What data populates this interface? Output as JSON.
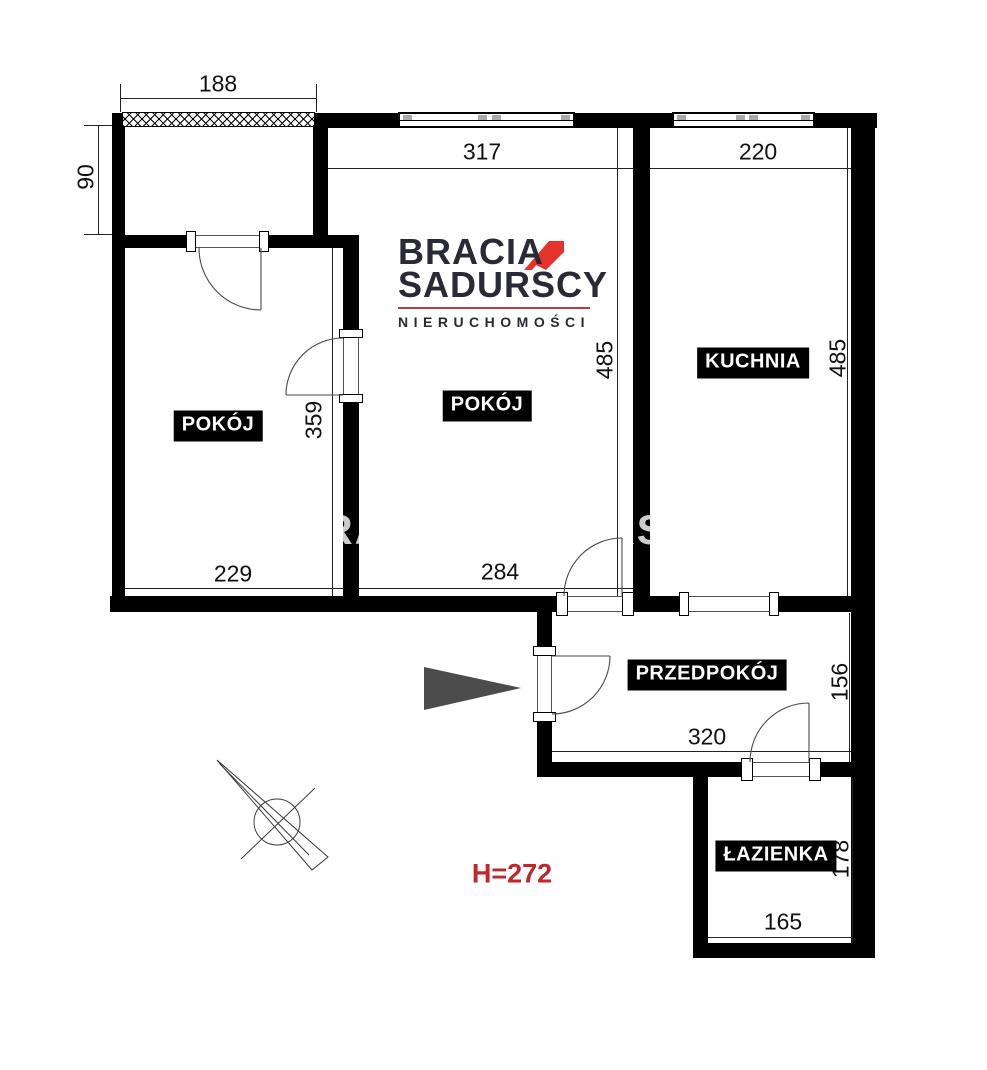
{
  "brand": {
    "line1": "BRACIA",
    "line2": "SADURSCY",
    "line3": "NIERUCHOMOŚCI",
    "logo_navy": "#2a2936",
    "logo_red": "#e5332a"
  },
  "watermark_text": "BRACIA SADURSCY",
  "rooms": [
    {
      "id": "pokoj-left",
      "label": "POKÓJ"
    },
    {
      "id": "pokoj-middle",
      "label": "POKÓJ"
    },
    {
      "id": "kuchnia",
      "label": "KUCHNIA"
    },
    {
      "id": "przedpokoj",
      "label": "PRZEDPOKÓJ"
    },
    {
      "id": "lazienka",
      "label": "ŁAZIENKA"
    }
  ],
  "dims": {
    "d188": "188",
    "d90": "90",
    "d317": "317",
    "d220": "220",
    "d485L": "485",
    "d485R": "485",
    "d359": "359",
    "d229": "229",
    "d284": "284",
    "d320": "320",
    "d156": "156",
    "d178": "178",
    "d165": "165"
  },
  "height_note": "H=272",
  "colors": {
    "wall": "#000000",
    "accent_red": "#c0272d",
    "arrow_gray": "#4c4c4c"
  },
  "symbols": {
    "entrance_arrow": "entrance-direction-arrow",
    "north_indicator": "north-compass-symbol"
  }
}
